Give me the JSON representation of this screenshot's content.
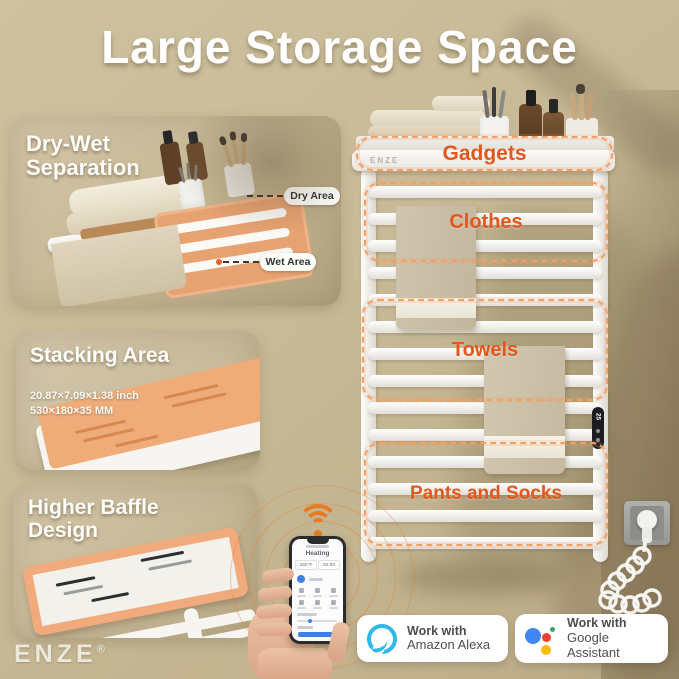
{
  "title": "Large Storage Space",
  "brand": {
    "logo": "ENZE",
    "registered": "®"
  },
  "panels": {
    "dry_wet": {
      "title_line1": "Dry-Wet",
      "title_line2": "Separation",
      "labels": {
        "dry": "Dry Area",
        "wet": "Wet Area"
      }
    },
    "stacking": {
      "title": "Stacking Area",
      "dim_inch": "20.87×7.09×1.38 inch",
      "dim_mm": "530×180×35 MM"
    },
    "baffle": {
      "title_line1": "Higher Baffle",
      "title_line2": "Design"
    }
  },
  "product": {
    "shelf_logo": "ENZE",
    "control_display": "25",
    "zones": [
      {
        "label": "Gadgets"
      },
      {
        "label": "Clothes"
      },
      {
        "label": "Towels"
      },
      {
        "label": "Pants and Socks"
      }
    ]
  },
  "phone": {
    "status": "Heating",
    "temperature": "150°F",
    "timer": "02:00"
  },
  "badges": [
    {
      "prefix": "Work with",
      "name": "Amazon Alexa",
      "icon": "alexa"
    },
    {
      "prefix": "Work with",
      "name": "Google Assistant",
      "icon": "google-assistant"
    }
  ],
  "colors": {
    "background_tan": "#C7B996",
    "accent_orange_text": "#E2571D",
    "zone_dash_orange": "#F2A066",
    "wifi_orange": "#E87B22",
    "alexa_blue": "#2FB8E8",
    "google_blue": "#4285F4",
    "google_red": "#EA4335",
    "google_yellow": "#FBBC05",
    "google_green": "#34A853"
  }
}
